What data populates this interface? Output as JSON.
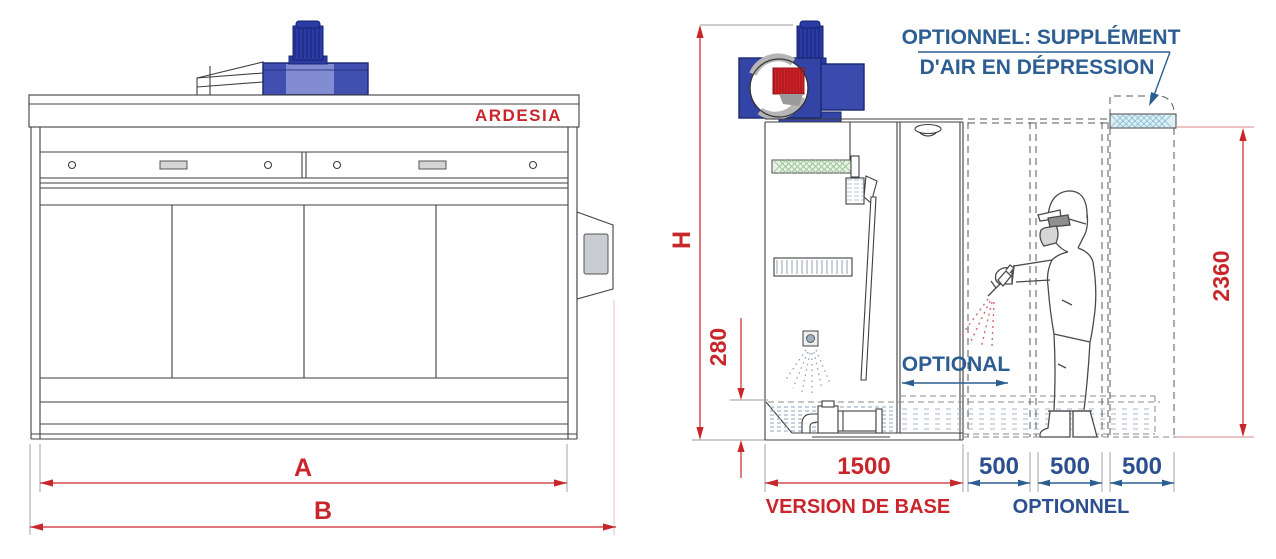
{
  "front": {
    "brand": "ARDESIA",
    "width_inner": {
      "label": "A"
    },
    "width_total": {
      "label": "B"
    }
  },
  "side": {
    "height": {
      "label": "H"
    },
    "tank_depth": {
      "value": "280"
    },
    "working_height": {
      "value": "2360"
    },
    "base_width": {
      "value": "1500"
    },
    "modules": [
      {
        "value": "500"
      },
      {
        "value": "500"
      },
      {
        "value": "500"
      }
    ],
    "optional_span": {
      "label": "OPTIONAL"
    },
    "note": {
      "line1": "OPTIONNEL: SUPPLÉMENT",
      "line2": "D'AIR EN DÉPRESSION"
    },
    "base_caption": "VERSION DE BASE",
    "optional_caption": "OPTIONNEL"
  },
  "colors": {
    "dimension_red": "#c9262c",
    "label_blue": "#2d5e92",
    "dim_blue": "#2c4f8f",
    "fan_blue": "#3344a6",
    "impeller_red": "#d02127",
    "filter_green": "#9cc49a",
    "air_inlet_cyan": "#8fc3d6"
  }
}
